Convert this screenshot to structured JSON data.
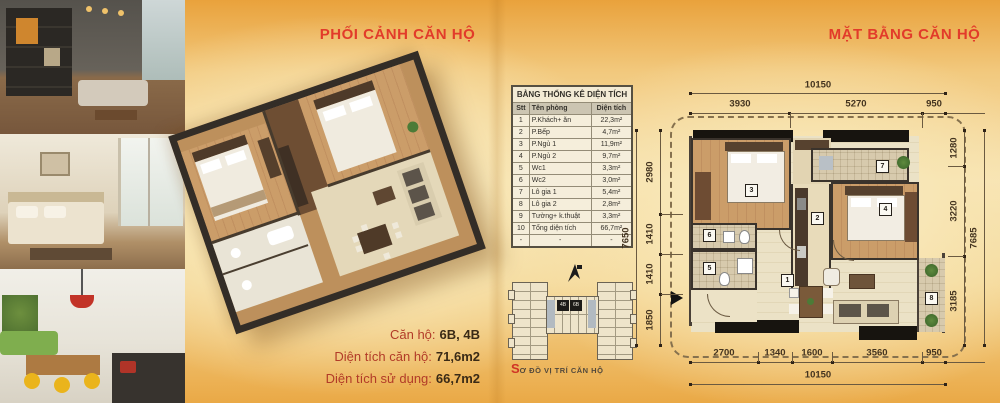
{
  "brand_colors": {
    "accent_red": "#e23b2a",
    "page_orange": "#eaa83f"
  },
  "perspective_page": {
    "title": "PHỐI CẢNH CĂN HỘ",
    "info_lines": [
      {
        "label": "Căn hộ:",
        "value": "6B, 4B"
      },
      {
        "label": "Diện tích căn hộ:",
        "value": "71,6m2"
      },
      {
        "label": "Diện tích sử dụng:",
        "value": "66,7m2"
      }
    ]
  },
  "area_table": {
    "title": "BẢNG THỐNG KÊ DIỆN TÍCH",
    "columns": [
      "Stt",
      "Tên phòng",
      "Diện tích"
    ],
    "rows": [
      [
        "1",
        "P.Khách+ ăn",
        "22,3m²"
      ],
      [
        "2",
        "P.Bếp",
        "4,7m²"
      ],
      [
        "3",
        "P.Ngủ 1",
        "11,9m²"
      ],
      [
        "4",
        "P.Ngủ 2",
        "9,7m²"
      ],
      [
        "5",
        "Wc1",
        "3,3m²"
      ],
      [
        "6",
        "Wc2",
        "3,0m²"
      ],
      [
        "7",
        "Lô gia 1",
        "5,4m²"
      ],
      [
        "8",
        "Lô gia 2",
        "2,8m²"
      ],
      [
        "9",
        "Tường+ k.thuật",
        "3,3m²"
      ],
      [
        "10",
        "Tổng diện tích",
        "66,7m²"
      ],
      [
        "-",
        "-",
        "-"
      ]
    ]
  },
  "location_diagram": {
    "caption_first": "S",
    "caption_rest": "Ơ ĐỒ VỊ TRÍ CĂN HỘ",
    "units": [
      "4B",
      "6B"
    ]
  },
  "floor_plan_page": {
    "title": "MẶT BẰNG CĂN HỘ",
    "room_labels": [
      "1",
      "2",
      "3",
      "4",
      "5",
      "6",
      "7",
      "8"
    ],
    "dims": {
      "top_overall": "10150",
      "top_segments": [
        "3930",
        "5270",
        "950"
      ],
      "bottom_segments": [
        "2700",
        "1340",
        "1600",
        "3560",
        "950"
      ],
      "bottom_overall": "10150",
      "left_overall": "7650",
      "left_segments": [
        "2980",
        "1410",
        "1410",
        "1850"
      ],
      "right_segments": [
        "1280",
        "3220",
        "3185"
      ],
      "right_overall": "7685"
    }
  }
}
